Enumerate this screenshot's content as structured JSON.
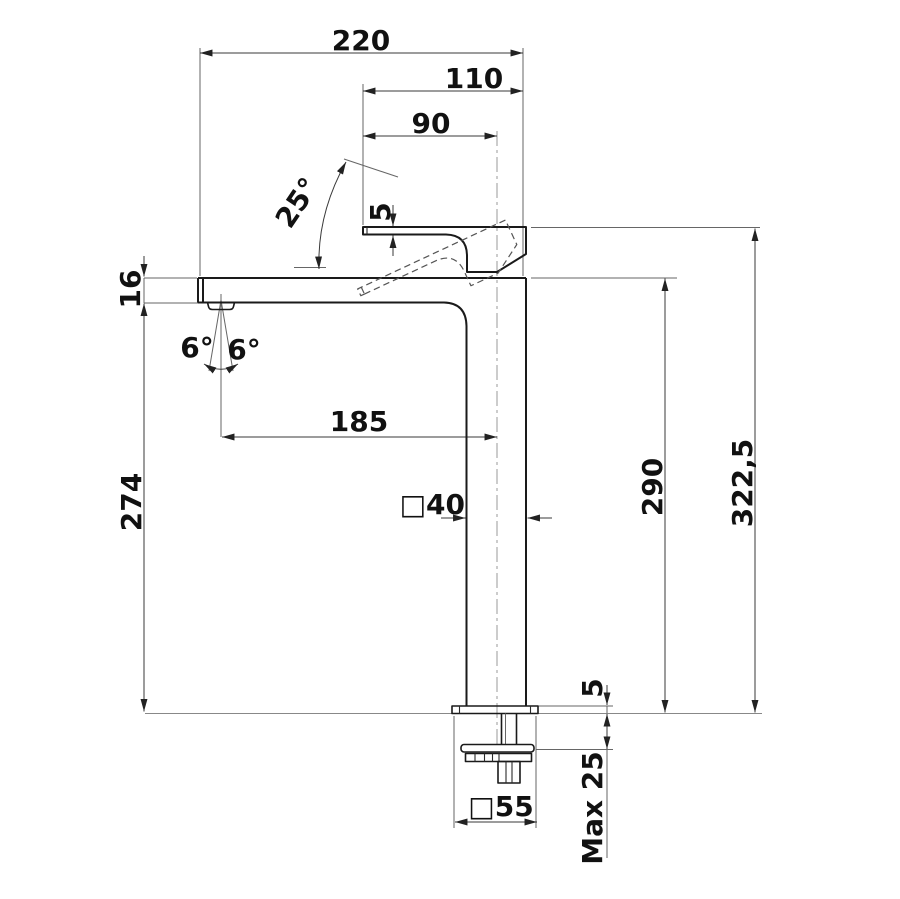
{
  "drawing": {
    "dims": {
      "overall_width": "220",
      "handle_width": "110",
      "handle_to_center": "90",
      "handle_angle": "25°",
      "handle_thickness": "5",
      "spout_end_height": "16",
      "spray_angle_left": "6°",
      "spray_angle_right": "6°",
      "spout_reach": "185",
      "spout_underside_height": "274",
      "body_section": "□40",
      "spout_top_height": "290",
      "overall_height": "322,5",
      "base_plate_height": "5",
      "max_counter_thickness": "Max 25",
      "base_section": "□55"
    },
    "colors": {
      "outline": "#1a1a1a",
      "dimension_lines": "#3a3a3a",
      "text": "#111111",
      "background": "#ffffff"
    }
  }
}
